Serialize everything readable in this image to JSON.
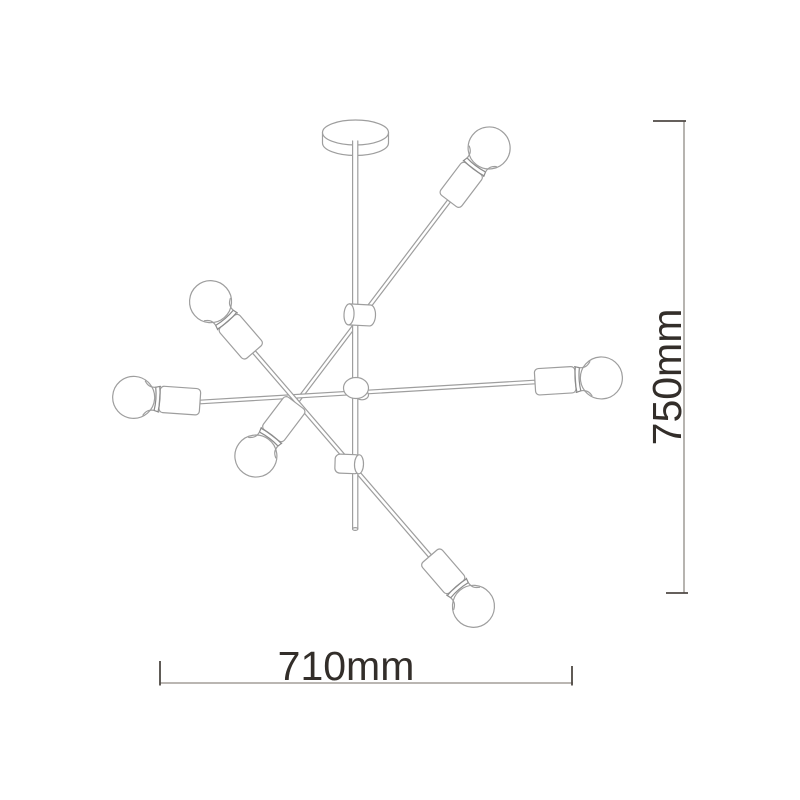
{
  "figure": {
    "description": "Technical line drawing of a six-light sputnik chandelier with overall dimensions",
    "bulb_count": 6
  },
  "dimensions": {
    "width": {
      "label": "710mm"
    },
    "height": {
      "label": "750mm"
    }
  },
  "colors": {
    "background": "#ffffff",
    "drawing_line": "#9e9e9e",
    "dimension_line": "#908b85",
    "dimension_tick": "#4f4944",
    "label_text": "#332e2a"
  }
}
